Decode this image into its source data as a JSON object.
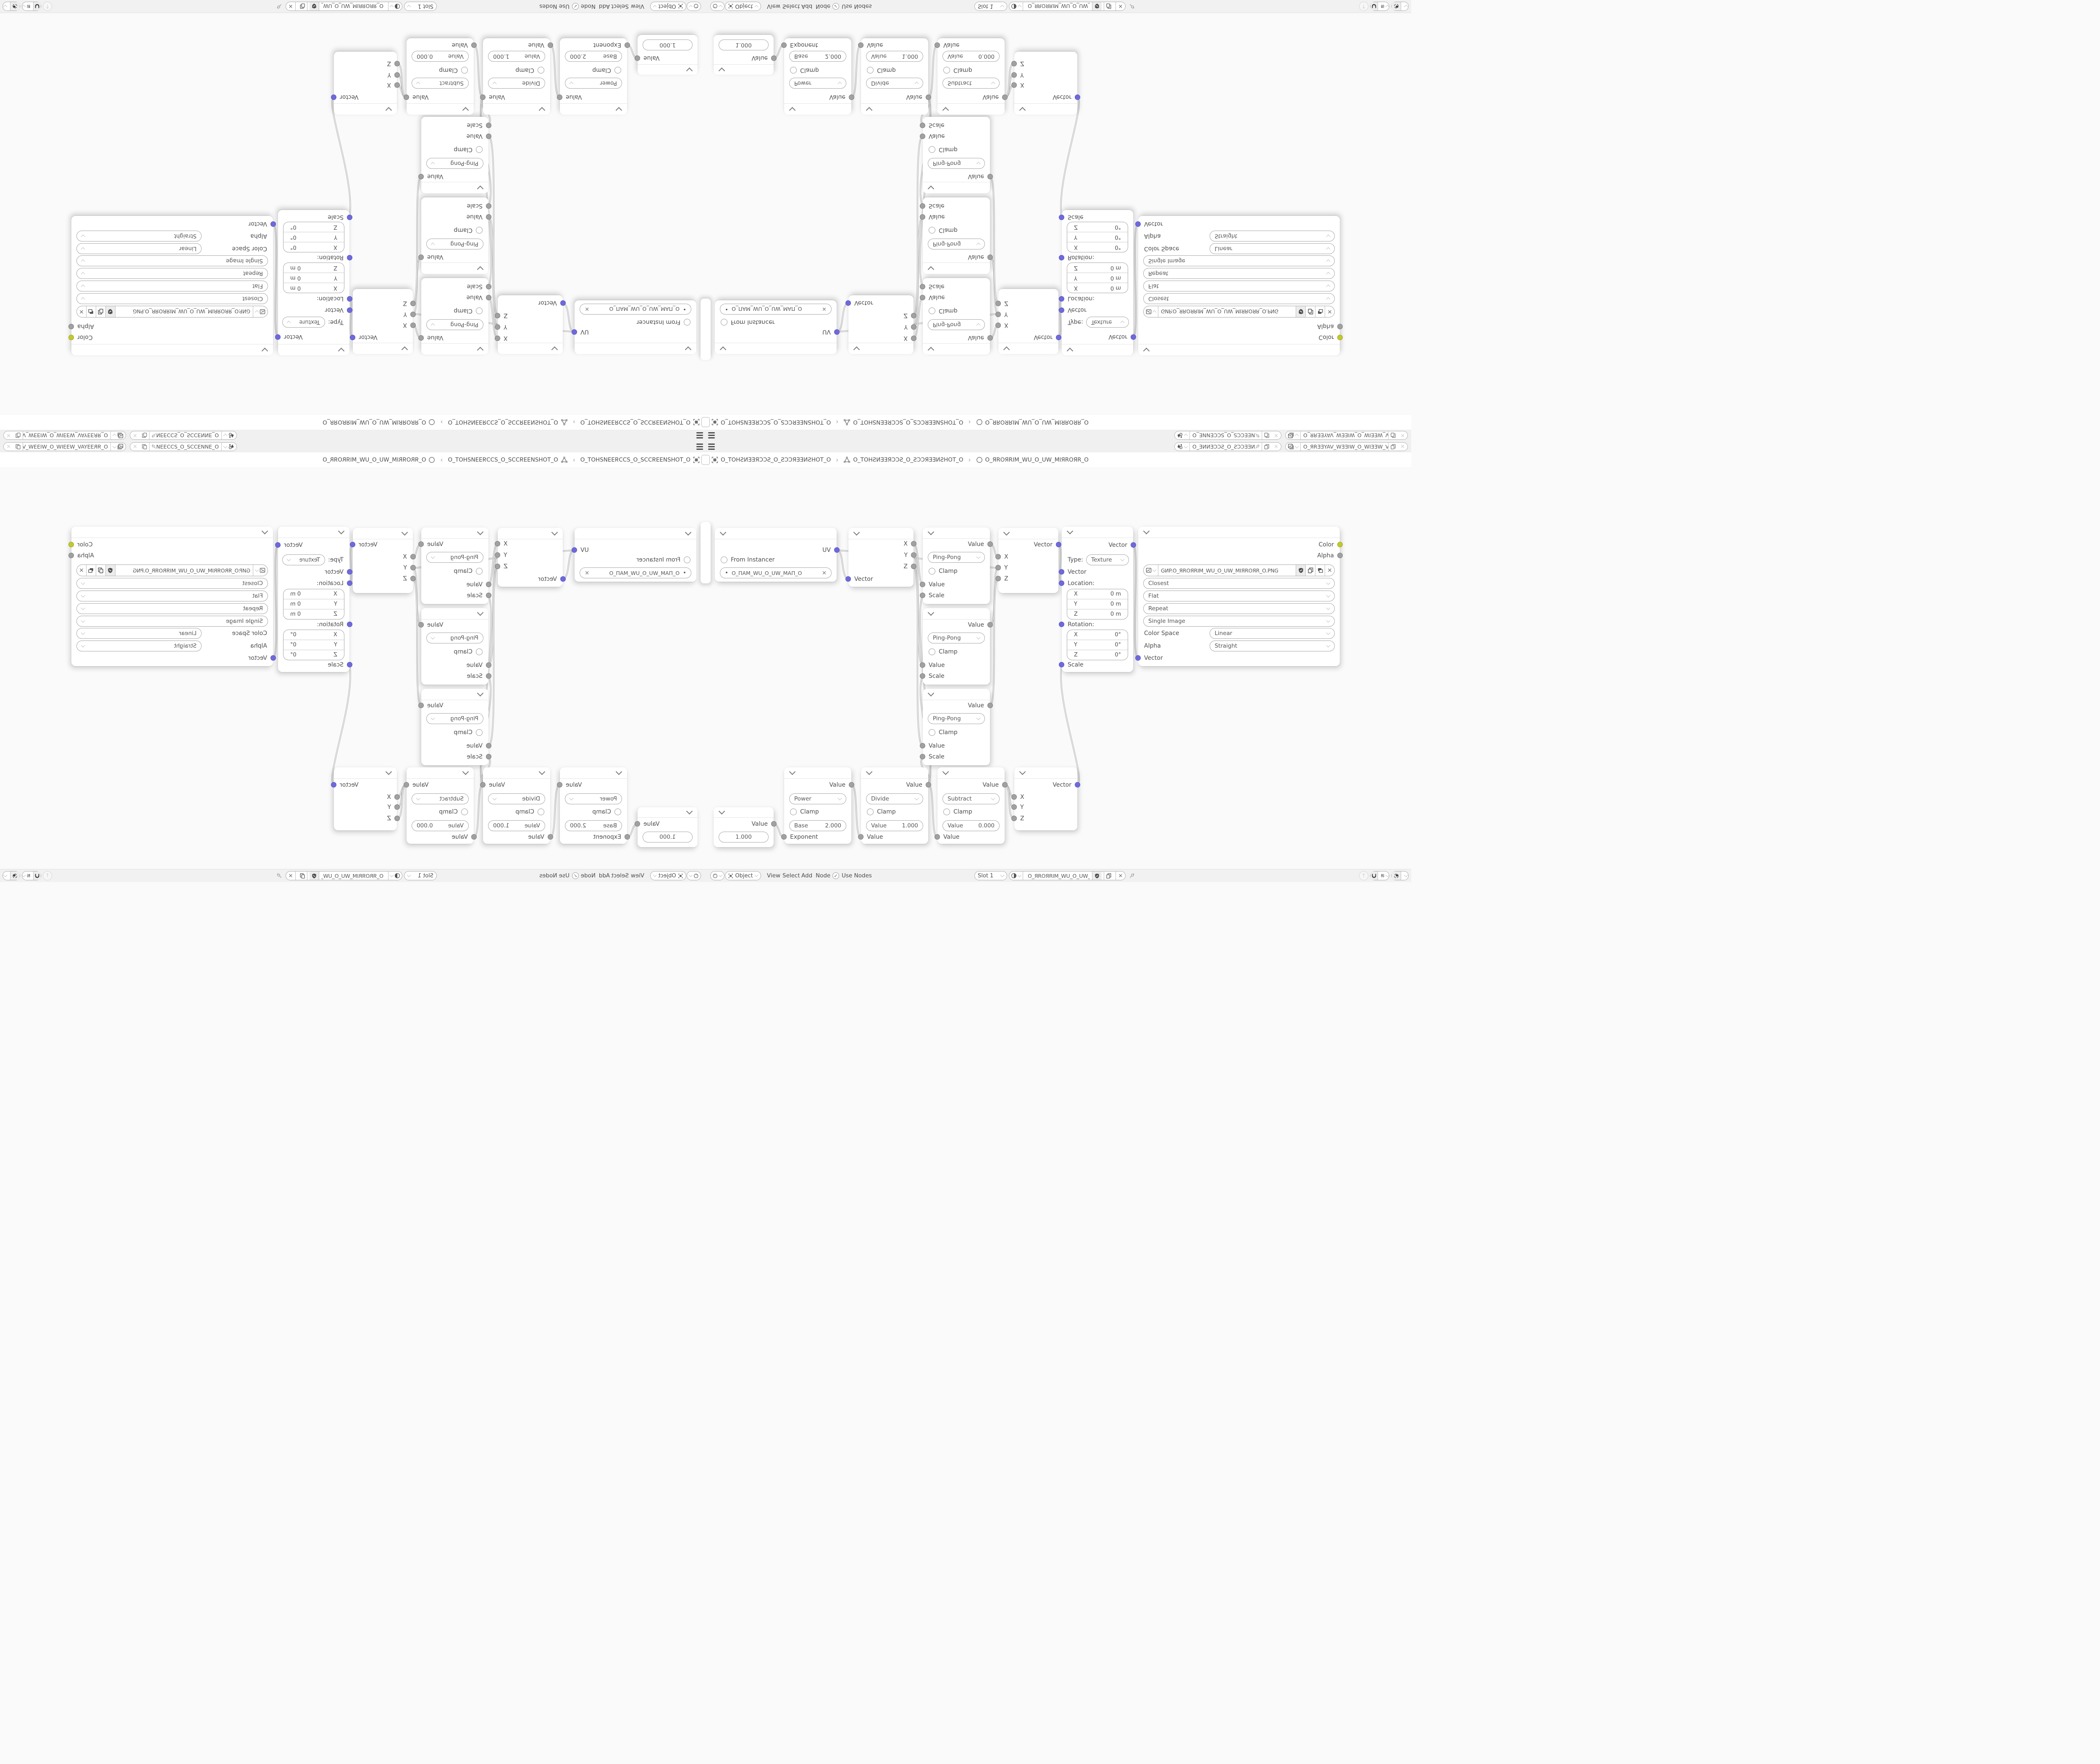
{
  "topbar": {
    "scene_name": "O_ƎИИƎƆƆƧ_O_ƧƆƆƎƎИ...",
    "viewlayer_name": "O_ЯRƎƎYAV_WƎƎIW_O_WIƎƎW_VAYƎƎRЯ_O"
  },
  "breadcrumb": {
    "separator": "›",
    "object_name": "O_TOHƧИƎƎЯƆƆƧ_O_ƧƆƆЯƎƎИƧHOT_O",
    "mesh_name": "O_TOHƧИƎƎЯƆƆƧ_O_ƧƆƆЯƎƎИƧHOT_O",
    "material_name": "O_ЯROЯRIM_WU_O_UW_MIЯROЯR_O"
  },
  "editor_header": {
    "mode": "Object",
    "menus": [
      "View",
      "Select",
      "Add",
      "Node"
    ],
    "use_nodes_label": "Use Nodes",
    "use_nodes_checked": "✓",
    "slot_label": "Slot 1",
    "image_name": "O_ЯROЯRIM_WU_O_UW_MIЯROЯR_O"
  },
  "nodes": {
    "uv_map": {
      "output_label": "UV",
      "from_instancer_label": "From Instancer",
      "uvmap_name": "O_ПAM_WU_O_UW_MAП_O",
      "clear_label": "×"
    },
    "separate_xyz": {
      "out_x": "X",
      "out_y": "Y",
      "out_z": "Z",
      "input_label": "Vector"
    },
    "ping_pong": {
      "output_label": "Value",
      "operation": "Ping-Pong",
      "clamp_label": "Clamp",
      "input1_label": "Value",
      "input2_label": "Scale"
    },
    "combine_xyz": {
      "output_label": "Vector",
      "in_x": "X",
      "in_y": "Y",
      "in_z": "Z"
    },
    "mapping": {
      "output_label": "Vector",
      "type_label": "Type:",
      "type_value": "Texture",
      "vector_label": "Vector",
      "location_label": "Location:",
      "rotation_label": "Rotation:",
      "scale_label": "Scale",
      "location_rows": [
        {
          "axis": "X",
          "value": "0 m"
        },
        {
          "axis": "Y",
          "value": "0 m"
        },
        {
          "axis": "Z",
          "value": "0 m"
        }
      ],
      "rotation_rows": [
        {
          "axis": "X",
          "value": "0°"
        },
        {
          "axis": "Y",
          "value": "0°"
        },
        {
          "axis": "Z",
          "value": "0°"
        }
      ]
    },
    "image_texture": {
      "output_color": "Color",
      "output_alpha": "Alpha",
      "image_name": "GИP.O_ЯROЯRIM_WU_O_UW_MIЯROЯR_O.PNG",
      "interpolation": "Closest",
      "projection": "Flat",
      "extension": "Repeat",
      "source": "Single Image",
      "colorspace_label": "Color Space",
      "colorspace_value": "Linear",
      "alpha_label": "Alpha",
      "alpha_value": "Straight",
      "input_label": "Vector",
      "unlink_label": "×"
    },
    "value_node": {
      "output_label": "Value",
      "value": "1.000"
    },
    "math_power": {
      "output_label": "Value",
      "operation": "Power",
      "clamp_label": "Clamp",
      "field_label": "Base",
      "field_value": "2.000",
      "input_label": "Exponent"
    },
    "math_divide": {
      "output_label": "Value",
      "operation": "Divide",
      "clamp_label": "Clamp",
      "field_label": "Value",
      "field_value": "1.000",
      "input_label": "Value"
    },
    "math_subtract": {
      "output_label": "Value",
      "operation": "Subtract",
      "clamp_label": "Clamp",
      "field_label": "Value",
      "field_value": "0.000",
      "input_label": "Value"
    }
  },
  "colors": {
    "vector_socket": "#6f6ada",
    "color_socket": "#c3c82e",
    "value_socket": "#a1a1a1",
    "canvas": "#fafafa",
    "bar": "#f1f1f1",
    "node_bg": "#ffffff",
    "text": "#4d4d4d"
  }
}
